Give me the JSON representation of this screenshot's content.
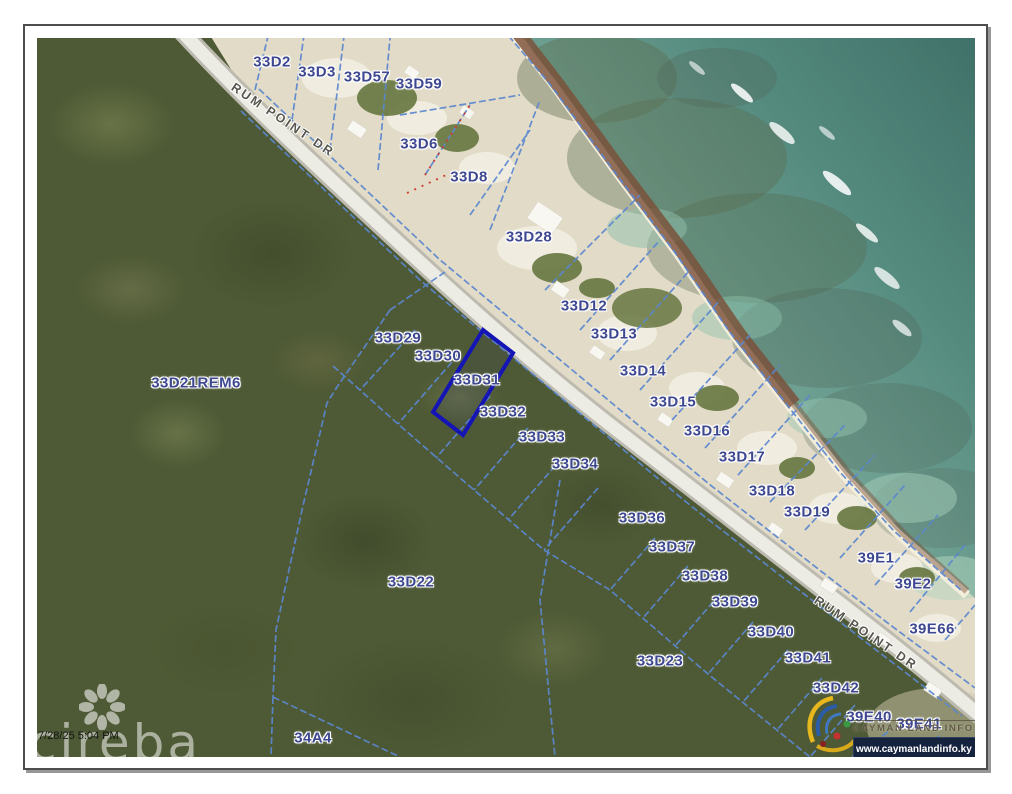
{
  "document": {
    "timestamp": "7/28/25 5:04 PM"
  },
  "map": {
    "road_name": "RUM POINT DR",
    "road_labels": [
      {
        "text": "RUM POINT DR",
        "x": 246,
        "y": 82,
        "rotation": 34
      },
      {
        "text": "RUM POINT DR",
        "x": 829,
        "y": 595,
        "rotation": 34
      }
    ],
    "highlighted_parcel": "33D31",
    "parcels": [
      {
        "label": "33D2",
        "x": 235,
        "y": 24
      },
      {
        "label": "33D3",
        "x": 280,
        "y": 34
      },
      {
        "label": "33D57",
        "x": 330,
        "y": 39
      },
      {
        "label": "33D59",
        "x": 382,
        "y": 46
      },
      {
        "label": "33D6",
        "x": 382,
        "y": 106
      },
      {
        "label": "33D8",
        "x": 432,
        "y": 139
      },
      {
        "label": "33D28",
        "x": 492,
        "y": 199
      },
      {
        "label": "33D12",
        "x": 547,
        "y": 268
      },
      {
        "label": "33D13",
        "x": 577,
        "y": 296
      },
      {
        "label": "33D14",
        "x": 606,
        "y": 333
      },
      {
        "label": "33D15",
        "x": 636,
        "y": 364
      },
      {
        "label": "33D16",
        "x": 670,
        "y": 393
      },
      {
        "label": "33D17",
        "x": 705,
        "y": 419
      },
      {
        "label": "33D18",
        "x": 735,
        "y": 453
      },
      {
        "label": "33D19",
        "x": 770,
        "y": 474
      },
      {
        "label": "39E1",
        "x": 839,
        "y": 520
      },
      {
        "label": "39E2",
        "x": 876,
        "y": 546
      },
      {
        "label": "39E66",
        "x": 895,
        "y": 591
      },
      {
        "label": "33D21REM6",
        "x": 159,
        "y": 345
      },
      {
        "label": "33D29",
        "x": 361,
        "y": 300
      },
      {
        "label": "33D30",
        "x": 401,
        "y": 318
      },
      {
        "label": "33D31",
        "x": 440,
        "y": 342,
        "highlighted": true
      },
      {
        "label": "33D32",
        "x": 466,
        "y": 374
      },
      {
        "label": "33D33",
        "x": 505,
        "y": 399
      },
      {
        "label": "33D34",
        "x": 538,
        "y": 426
      },
      {
        "label": "33D36",
        "x": 605,
        "y": 480
      },
      {
        "label": "33D37",
        "x": 635,
        "y": 509
      },
      {
        "label": "33D38",
        "x": 668,
        "y": 538
      },
      {
        "label": "33D39",
        "x": 698,
        "y": 564
      },
      {
        "label": "33D40",
        "x": 734,
        "y": 594
      },
      {
        "label": "33D41",
        "x": 771,
        "y": 620
      },
      {
        "label": "33D42",
        "x": 799,
        "y": 650
      },
      {
        "label": "33D22",
        "x": 374,
        "y": 544
      },
      {
        "label": "33D23",
        "x": 623,
        "y": 623
      },
      {
        "label": "34A4",
        "x": 276,
        "y": 700
      },
      {
        "label": "39E40",
        "x": 832,
        "y": 679
      },
      {
        "label": "39E41",
        "x": 882,
        "y": 686
      },
      {
        "label": "39E42",
        "x": 906,
        "y": 711
      }
    ]
  },
  "branding": {
    "watermark": "cireba",
    "provider": {
      "name": "CAYMAN LAND INFO",
      "url": "www.caymanlandinfo.ky"
    }
  },
  "colors": {
    "parcel_line": "#5b87cf",
    "highlight_outline": "#1515b5",
    "parcel_label": "#3e4890",
    "ocean_deep": "#3e6e66",
    "ocean_shallow": "#a6cab8",
    "forest": "#4e5a35",
    "sand": "#e1dbc7",
    "road": "#edece4",
    "seaweed": "#7b4e36",
    "url_bar": "#16233f"
  }
}
